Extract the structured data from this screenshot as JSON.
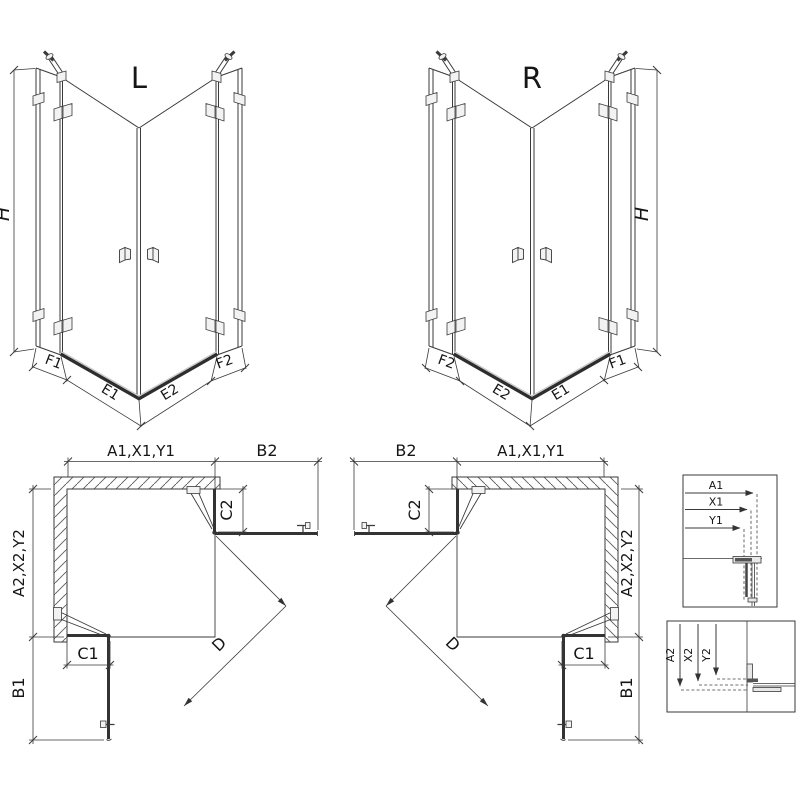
{
  "colors": {
    "line": "#3a3a3a",
    "background": "#ffffff",
    "threshold": "#2e2e2e"
  },
  "views": {
    "iso_left": {
      "label": "L",
      "height_dim": "H",
      "bottom_dims": [
        "F1",
        "E1",
        "E2",
        "F2"
      ]
    },
    "iso_right": {
      "label": "R",
      "height_dim": "H",
      "bottom_dims": [
        "F2",
        "E2",
        "E1",
        "F1"
      ]
    },
    "plan_left": {
      "top_dim": "A1,X1,Y1",
      "door_dim": "B2",
      "fixed_top_dim": "C2",
      "side_dim": "A2,X2,Y2",
      "fixed_bottom_dim": "C1",
      "door_side_dim": "B1",
      "diagonal_dim": "D"
    },
    "plan_right": {
      "top_dim": "A1,X1,Y1",
      "door_dim": "B2",
      "fixed_top_dim": "C2",
      "side_dim": "A2,X2,Y2",
      "fixed_bottom_dim": "C1",
      "door_side_dim": "B1",
      "diagonal_dim": "D"
    }
  },
  "details": {
    "width_box": {
      "dims": [
        "A1",
        "X1",
        "Y1"
      ]
    },
    "depth_box": {
      "dims": [
        "A2",
        "X2",
        "Y2"
      ]
    }
  }
}
